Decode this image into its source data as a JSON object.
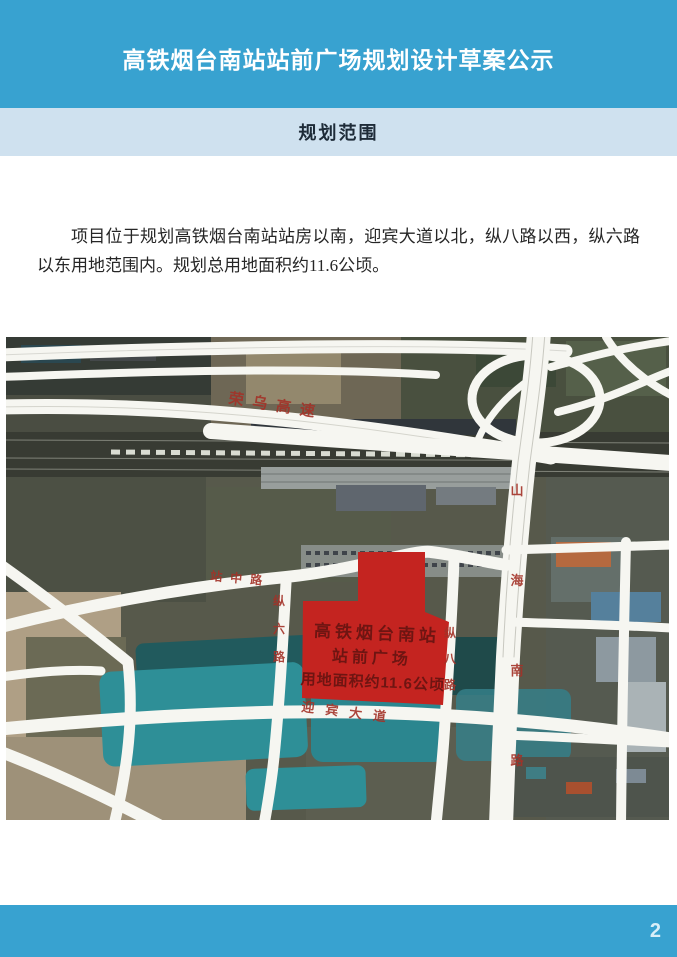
{
  "header": {
    "title": "高铁烟台南站站前广场规划设计草案公示"
  },
  "section": {
    "title": "规划范围"
  },
  "body": {
    "paragraph": "项目位于规划高铁烟台南站站房以南，迎宾大道以北，纵八路以西，纵六路以东用地范围内。规划总用地面积约11.6公顷。"
  },
  "map": {
    "site_label": {
      "line1": "高铁烟台南站",
      "line2": "站前广场",
      "line3": "用地面积约11.6公顷"
    },
    "roads": {
      "expressway": "荣乌高速",
      "station_road": "站中路",
      "zong6": "纵六路",
      "zong8": "纵八路",
      "shanhai": "山海南路",
      "yingbin": "迎宾大道"
    },
    "colors": {
      "site_fill": "#c42420",
      "site_text": "#6e1512",
      "road_label": "#a33228",
      "road_fill": "#f6f6f1",
      "water": "#2e8f97"
    }
  },
  "footer": {
    "page_number": "2"
  },
  "colors": {
    "header_bg": "#38a2d0",
    "section_bg": "#cfe1ef",
    "footer_bg": "#38a2d0"
  }
}
